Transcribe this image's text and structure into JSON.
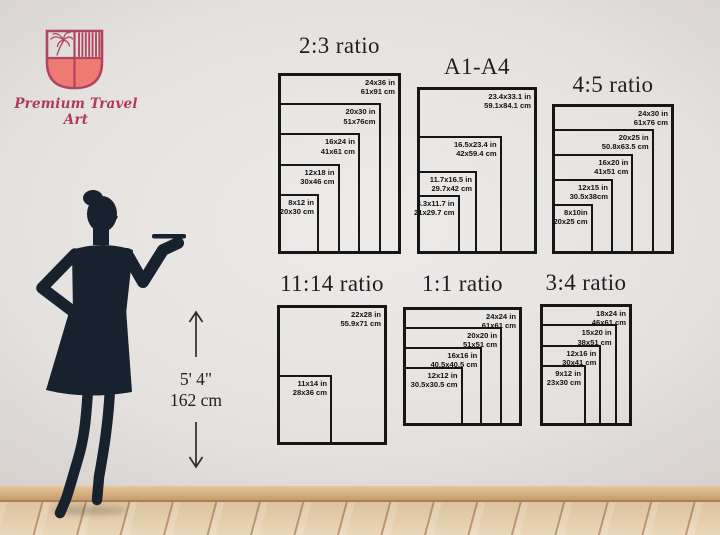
{
  "brand": {
    "name": "Premium Travel Art",
    "colors": {
      "crest_outline": "#b2455e",
      "crest_fill": "#ee7b71",
      "text": "#ae3a5f"
    }
  },
  "icons": {
    "shield": "brand-crest-shield-icon",
    "up_arrow": "up-arrow-icon",
    "down_arrow": "down-arrow-icon",
    "woman": "woman-silhouette"
  },
  "height_marker": {
    "feet": "5' 4\"",
    "cm": "162 cm"
  },
  "charts": [
    {
      "title": "2:3 ratio",
      "title_y": 33,
      "frame": {
        "x": 278,
        "y": 73,
        "w": 123,
        "h": 181
      },
      "sizes": [
        {
          "inch": "24x36 in",
          "cm": "61x91 cm",
          "w": 24,
          "h": 36
        },
        {
          "inch": "20x30 in",
          "cm": "51x76cm",
          "w": 20,
          "h": 30
        },
        {
          "inch": "16x24 in",
          "cm": "41x61 cm",
          "w": 16,
          "h": 24
        },
        {
          "inch": "12x18 in",
          "cm": "30x46 cm",
          "w": 12,
          "h": 18
        },
        {
          "inch": "8x12 in",
          "cm": "20x30 cm",
          "w": 8,
          "h": 12
        }
      ]
    },
    {
      "title": "A1-A4",
      "title_y": 54,
      "frame": {
        "x": 417,
        "y": 87,
        "w": 120,
        "h": 167
      },
      "sizes": [
        {
          "inch": "23.4x33.1 in",
          "cm": "59.1x84.1 cm",
          "w": 23.4,
          "h": 33.1
        },
        {
          "inch": "16.5x23.4 in",
          "cm": "42x59.4 cm",
          "w": 16.5,
          "h": 23.4
        },
        {
          "inch": "11.7x16.5 in",
          "cm": "29.7x42 cm",
          "w": 11.7,
          "h": 16.5
        },
        {
          "inch": "8.3x11.7 in",
          "cm": "21x29.7 cm",
          "w": 8.3,
          "h": 11.7
        }
      ]
    },
    {
      "title": "4:5 ratio",
      "title_y": 72,
      "frame": {
        "x": 552,
        "y": 104,
        "w": 122,
        "h": 150
      },
      "sizes": [
        {
          "inch": "24x30 in",
          "cm": "61x76 cm",
          "w": 24,
          "h": 30
        },
        {
          "inch": "20x25 in",
          "cm": "50.8x63.5 cm",
          "w": 20,
          "h": 25
        },
        {
          "inch": "16x20 in",
          "cm": "41x51 cm",
          "w": 16,
          "h": 20
        },
        {
          "inch": "12x15 in",
          "cm": "30.5x38cm",
          "w": 12,
          "h": 15
        },
        {
          "inch": "8x10in",
          "cm": "20x25 cm",
          "w": 8,
          "h": 10
        }
      ]
    },
    {
      "title": "11:14 ratio",
      "title_y": 271,
      "frame": {
        "x": 277,
        "y": 305,
        "w": 110,
        "h": 140
      },
      "sizes": [
        {
          "inch": "22x28 in",
          "cm": "55.9x71 cm",
          "w": 22,
          "h": 28
        },
        {
          "inch": "11x14 in",
          "cm": "28x36 cm",
          "w": 11,
          "h": 14
        }
      ]
    },
    {
      "title": "1:1 ratio",
      "title_y": 271,
      "frame": {
        "x": 403,
        "y": 307,
        "w": 119,
        "h": 119
      },
      "sizes": [
        {
          "inch": "24x24 in",
          "cm": "61x61 cm",
          "w": 24,
          "h": 24
        },
        {
          "inch": "20x20 in",
          "cm": "51x51 cm",
          "w": 20,
          "h": 20
        },
        {
          "inch": "16x16 in",
          "cm": "40.5x40.5 cm",
          "w": 16,
          "h": 16
        },
        {
          "inch": "12x12 in",
          "cm": "30.5x30.5 cm",
          "w": 12,
          "h": 12
        }
      ]
    },
    {
      "title": "3:4 ratio",
      "title_y": 270,
      "frame": {
        "x": 540,
        "y": 304,
        "w": 92,
        "h": 122
      },
      "sizes": [
        {
          "inch": "18x24 in",
          "cm": "46x61 cm",
          "w": 18,
          "h": 24
        },
        {
          "inch": "15x20 in",
          "cm": "38x51 cm",
          "w": 15,
          "h": 20
        },
        {
          "inch": "12x16 in",
          "cm": "30x41 cm",
          "w": 12,
          "h": 16
        },
        {
          "inch": "9x12 in",
          "cm": "23x30 cm",
          "w": 9,
          "h": 12
        }
      ]
    }
  ]
}
